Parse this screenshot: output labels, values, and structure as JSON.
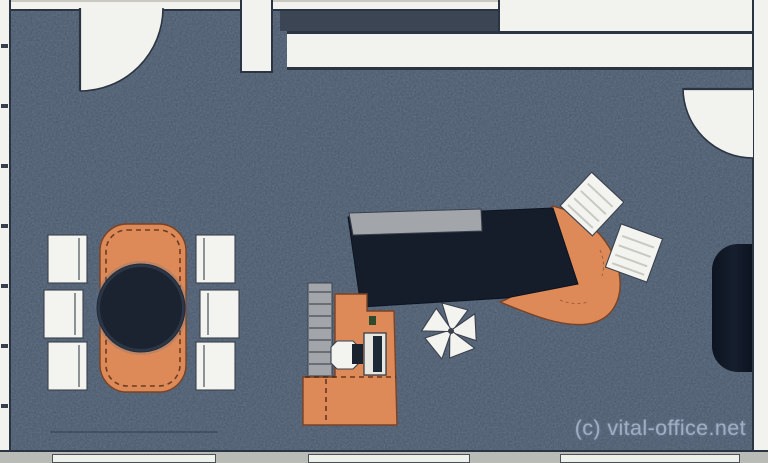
{
  "watermark": {
    "text": "(c) vital-office.net"
  },
  "palette": {
    "floor": "#47566a",
    "wall": "#f2f2ee",
    "wall_outline": "#2b3442",
    "window_sill": "#b9bcb6",
    "furniture_orange": "#dd8a58",
    "furniture_orange_outline": "#7c4224",
    "dark_surface": "#151d2b",
    "screen_gray": "#a2a6ab",
    "chair_white": "#f3f3ef",
    "watermark_color": "#a5b4c8"
  },
  "scene": {
    "type": "office-floor-plan-top-view",
    "areas": [
      {
        "name": "conference-area",
        "items": [
          "oval-conference-table",
          "round-dark-table-top",
          "conference-chairs-x6"
        ]
      },
      {
        "name": "desk-area",
        "items": [
          "executive-desk-dark-top",
          "desk-privacy-screen",
          "curved-orange-desk-return",
          "guest-chair-x2",
          "chair-star-base",
          "workstation-sideboard",
          "shelf-rail",
          "task-chair",
          "monitor-block"
        ]
      },
      {
        "name": "wall-elements",
        "items": [
          "door-top-left-with-swing-arc",
          "door-right-with-swing-arc",
          "window-band-top",
          "window-sill-bottom",
          "tall-cabinet-right-wall"
        ]
      }
    ]
  }
}
